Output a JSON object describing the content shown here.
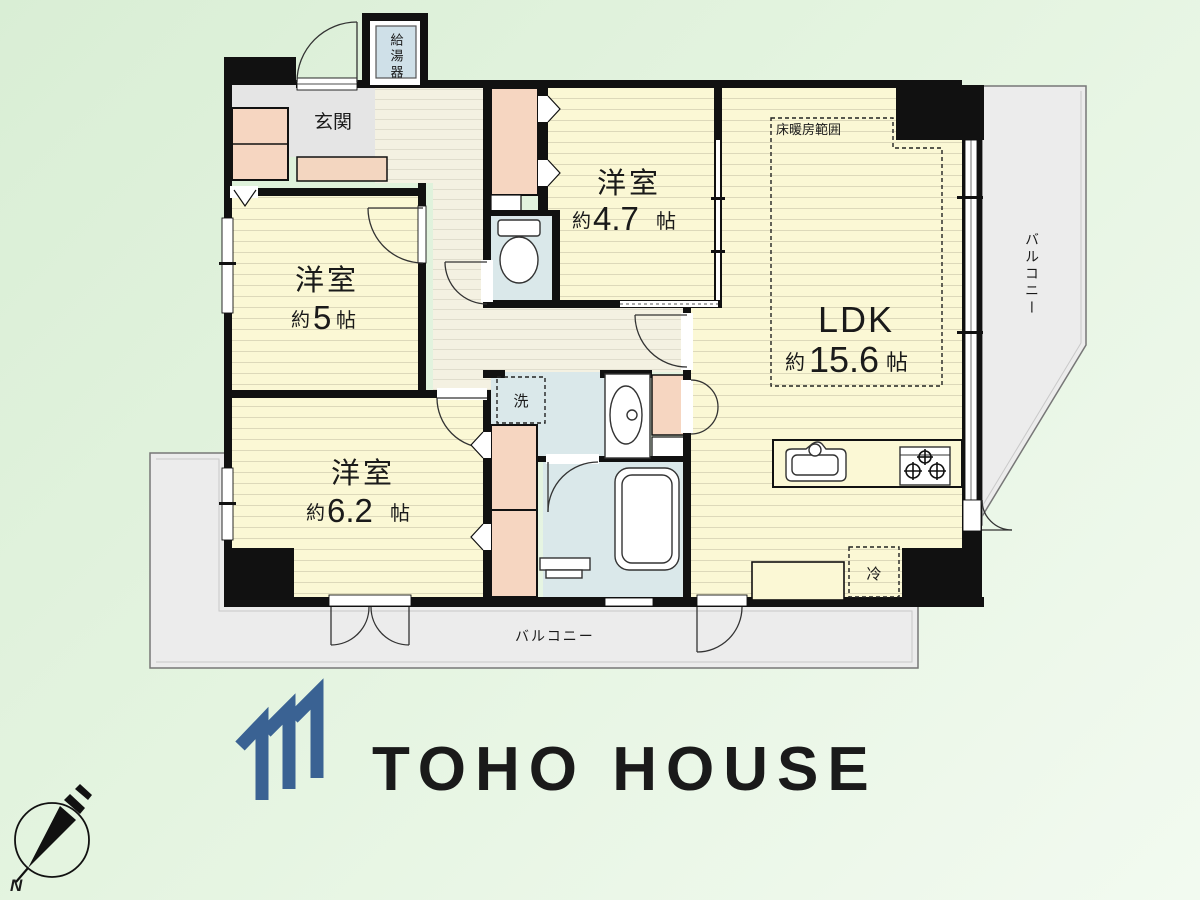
{
  "rooms": {
    "entrance": "玄関",
    "water_heater": "給湯器",
    "western_room_47": {
      "name": "洋室",
      "approx": "約",
      "size": "4.7",
      "unit": "帖"
    },
    "western_room_5": {
      "name": "洋室",
      "approx": "約",
      "size": "5",
      "unit": "帖"
    },
    "western_room_62": {
      "name": "洋室",
      "approx": "約",
      "size": "6.2",
      "unit": "帖"
    },
    "ldk": {
      "name": "LDK",
      "approx": "約",
      "size": "15.6",
      "unit": "帖"
    },
    "floor_heating_area": "床暖房範囲",
    "washer": "洗",
    "fridge": "冷",
    "balcony_right": "バルコニー",
    "balcony_bottom": "バルコニー"
  },
  "compass": {
    "north": "N"
  },
  "branding": {
    "name": "TOHO HOUSE",
    "color": "#3a6293"
  },
  "palette": {
    "wall": "#111111",
    "room_yellow": "#fbf8d5",
    "hall_cream": "#f4f1e2",
    "wet_blue": "#dae8ea",
    "closet_peach": "#f6d6c1",
    "entrance_gray": "#e5e5e5",
    "balcony_gray": "#ececec",
    "logo_blue": "#3a6293",
    "heater_label_bg": "#cfe0e8"
  }
}
